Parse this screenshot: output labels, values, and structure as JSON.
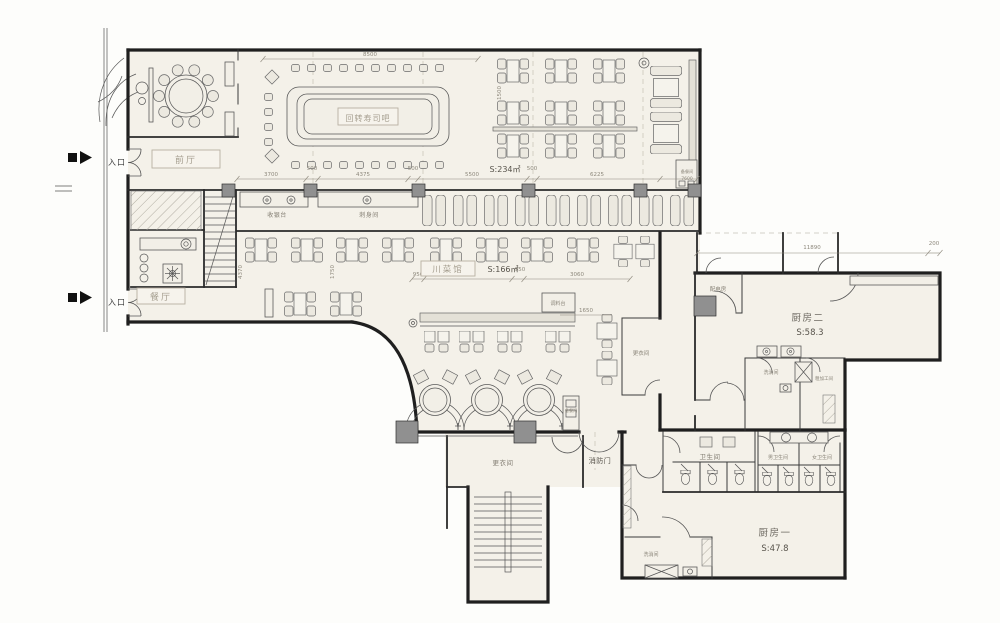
{
  "plan": {
    "entrance_label": "入口",
    "rooms": {
      "front_hall": "前厅",
      "dining_hall": "餐厅",
      "sushi_bar": "回转寿司吧",
      "sushi_area": "S:234㎡",
      "cashier": "收银台",
      "sashimi_room": "刺身间",
      "sichuan_hall": "川菜馆",
      "sichuan_area": "S:166㎡",
      "condiment_station": "调料台",
      "pantry": "备餐间",
      "locker_room_a": "更衣间",
      "locker_room_b": "更衣间",
      "fire_door": "消防门",
      "power_room": "配电房",
      "kitchen_two": "厨房二",
      "kitchen_two_area": "S:58.3",
      "wash_room_a": "洗消间",
      "rough_prep": "粗加工间",
      "toilet": "卫生间",
      "mens_toilet": "男卫生间",
      "womens_toilet": "女卫生间",
      "kitchen_one": "厨房一",
      "kitchen_one_area": "S:47.8",
      "wash_room_b": "洗消间"
    },
    "dims": {
      "d8500": "8500",
      "d3700": "3700",
      "d500a": "500",
      "d4375": "4375",
      "d500b": "500",
      "d5500": "5500",
      "d500c": "500",
      "d6225": "6225",
      "d7600": "7600",
      "d1500": "1500",
      "d4370": "4370",
      "d1750": "1750",
      "d950a": "950",
      "d5050": "5050",
      "d950b": "950",
      "d3060": "3060",
      "d1650": "1650",
      "d11890": "11890",
      "d200": "200"
    }
  }
}
